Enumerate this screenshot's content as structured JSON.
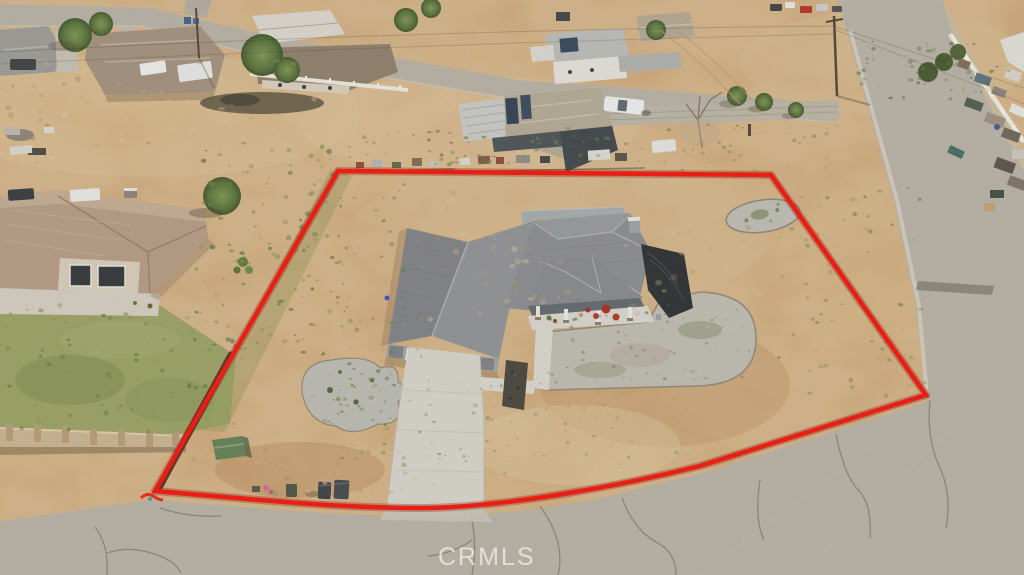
{
  "scene": {
    "type": "aerial-drone-photo",
    "subject": "single-story gray-roof house on large dirt lot outlined in red",
    "overlay": "red property boundary outline"
  },
  "watermark": {
    "text": "CRMLS"
  },
  "palette": {
    "boundary_red": "#e81f15",
    "dirt": "#c9a172",
    "dirt_light": "#dcc298",
    "road_asphalt": "#b7b1a6",
    "top_street": "#b6b0a5",
    "roof_gray": "#878b90",
    "roof_flat_gray": "#a3abad",
    "neighbor_roof_tan": "#b29880",
    "concrete": "#d6d4cd",
    "gravel": "#bdbdb6",
    "grass_green": "#7a8a4c",
    "block_wall_tan": "#c9b392",
    "shed_green": "#5f7e54",
    "tarp_dark": "#272c2f",
    "watermark_white": "#ffffff"
  }
}
